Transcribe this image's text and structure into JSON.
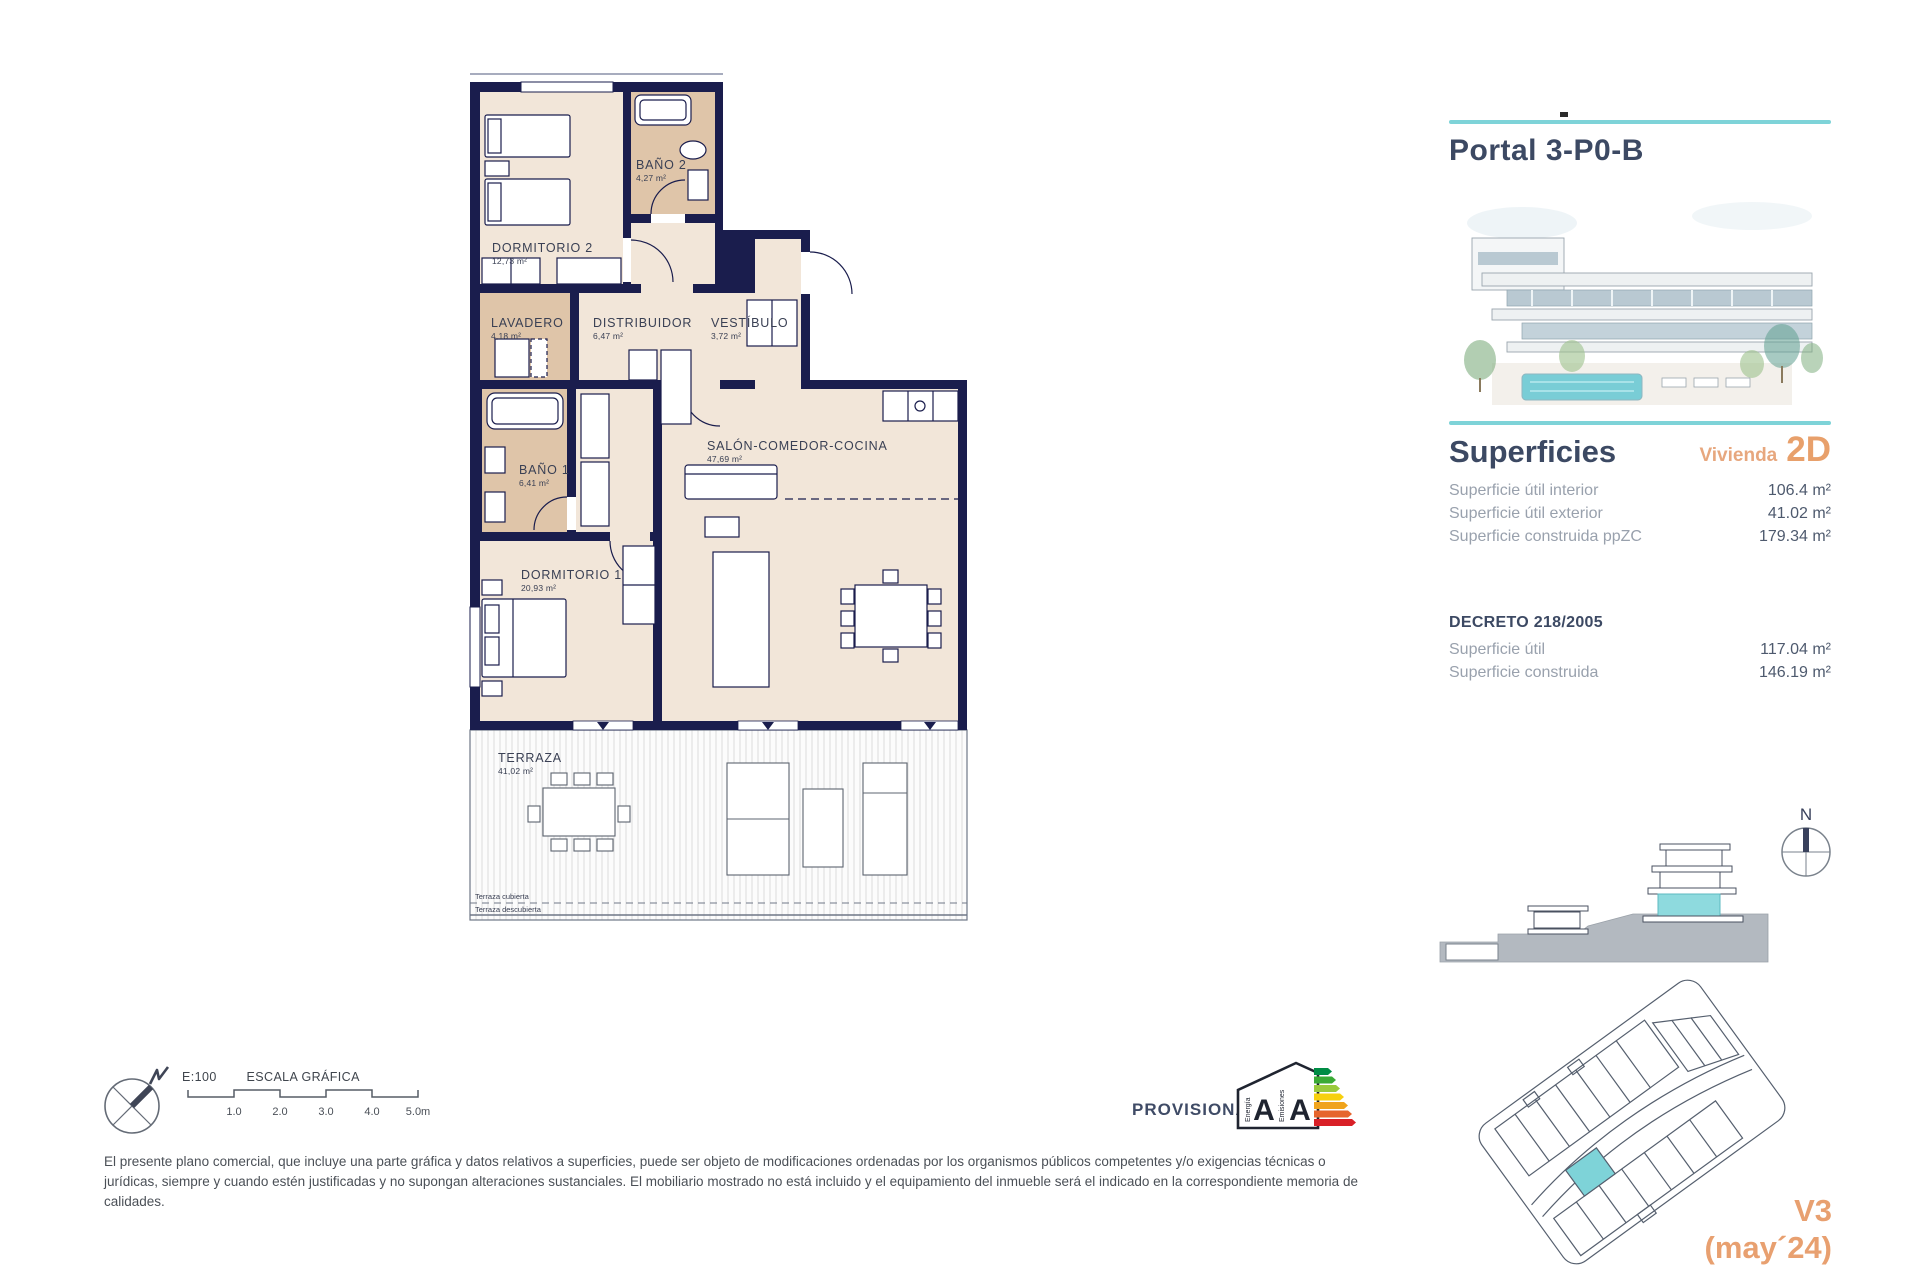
{
  "floor_plan": {
    "rooms": [
      {
        "name": "DORMITORIO 2",
        "area": "12,73 m²"
      },
      {
        "name": "BAÑO 2",
        "area": "4,27 m²"
      },
      {
        "name": "LAVADERO",
        "area": "4,18 m²"
      },
      {
        "name": "DISTRIBUIDOR",
        "area": "6,47 m²"
      },
      {
        "name": "VESTÍBULO",
        "area": "3,72 m²"
      },
      {
        "name": "BAÑO 1",
        "area": "6,41 m²"
      },
      {
        "name": "DORMITORIO 1",
        "area": "20,93 m²"
      },
      {
        "name": "SALÓN-COMEDOR-COCINA",
        "area": "47,69 m²"
      },
      {
        "name": "TERRAZA",
        "area": "41,02 m²"
      }
    ],
    "terrace_zone_labels": [
      "Terraza cubierta",
      "Terraza descubierta"
    ]
  },
  "side_panel": {
    "title": "Portal 3-P0-B",
    "superficies_heading": "Superficies",
    "vivienda_label": "Vivienda",
    "vivienda_code": "2D",
    "superficies_rows": [
      {
        "label": "Superficie útil interior",
        "value": "106.4 m²"
      },
      {
        "label": "Superficie útil exterior",
        "value": "41.02 m²"
      },
      {
        "label": "Superficie construida ppZC",
        "value": "179.34 m²"
      }
    ],
    "decreto_heading": "DECRETO 218/2005",
    "decreto_rows": [
      {
        "label": "Superficie útil",
        "value": "117.04 m²"
      },
      {
        "label": "Superficie construida",
        "value": "146.19 m²"
      }
    ],
    "section_compass_label": "N",
    "version": "V3",
    "version_date": "(may´24)"
  },
  "footer": {
    "scale_ratio": "E:100",
    "scale_title": "ESCALA GRÁFICA",
    "scale_ticks": [
      "1.0",
      "2.0",
      "3.0",
      "4.0",
      "5.0m"
    ],
    "provisional_label": "PROVISIONAL",
    "energy_label_left": "Energía",
    "energy_label_right": "Emisiones",
    "energy_letter_left": "A",
    "energy_letter_right": "A",
    "disclaimer": "El presente plano comercial, que incluye una parte gráfica y datos relativos a superficies, puede ser objeto de modificaciones ordenadas por los organismos públicos competentes y/o exigencias técnicas o jurídicas, siempre y cuando estén justificadas y no supongan alteraciones sustanciales. El mobiliario mostrado no está incluido y el equipamiento del inmueble será el indicado en la correspondiente memoria de calidades."
  },
  "colors": {
    "wall_navy": "#1a1d4d",
    "room_beige": "#f2e6d9",
    "wet_room_tan": "#dfc5a9",
    "accent_teal": "#7ed3d8",
    "accent_orange": "#e8a070",
    "heading_navy": "#3c4963",
    "label_gray": "#99a1ad",
    "energy_bar_colors": [
      "#008c45",
      "#3aaa35",
      "#9aca3c",
      "#f7d00e",
      "#f0a41c",
      "#e6652d",
      "#d92027"
    ]
  }
}
